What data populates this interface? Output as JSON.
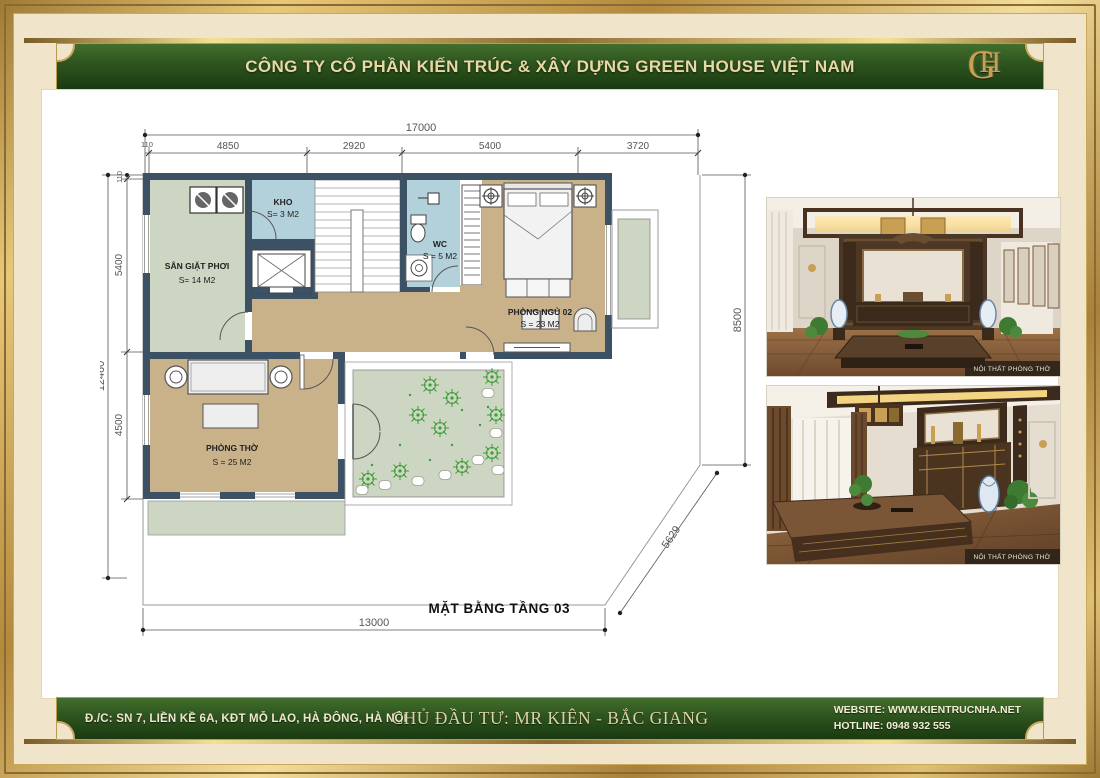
{
  "header": {
    "company": "CÔNG TY CỔ PHẦN KIẾN TRÚC & XÂY DỰNG GREEN HOUSE VIỆT NAM",
    "logo_monogram_g": "G",
    "logo_monogram_h": "H"
  },
  "plan": {
    "title": "MẶT BẰNG TẦNG 03",
    "dims": {
      "top_total": "17000",
      "top_segments": [
        "110",
        "4850",
        "2920",
        "5400",
        "3720"
      ],
      "left_total": "12460",
      "left_segments": [
        "110",
        "5400",
        "4500"
      ],
      "right_side": "8500",
      "diagonal": "5629",
      "bottom": "13000"
    },
    "rooms": {
      "laundry": {
        "name": "SÂN GIẶT PHƠI",
        "area": "S= 14 M2"
      },
      "storage": {
        "name": "KHO",
        "area": "S= 3 M2"
      },
      "wc": {
        "name": "WC",
        "area": "S = 5 M2"
      },
      "bedroom": {
        "name": "PHÒNG NGỦ 02",
        "area": "S = 23 M2"
      },
      "worship": {
        "name": "PHÒNG THỜ",
        "area": "S = 25 M2"
      }
    }
  },
  "photos": [
    {
      "caption": "NỘI THẤT PHÒNG THỜ"
    },
    {
      "caption": "NỘI THẤT PHÒNG THỜ"
    }
  ],
  "footer": {
    "address": "Đ./C: SN 7, LIỀN KỀ 6A, KĐT MỖ LAO, HÀ ĐÔNG, HÀ NỘI",
    "investor": "CHỦ ĐẦU TƯ:  MR KIÊN - BẮC GIANG",
    "website": "WEBSITE: WWW.KIENTRUCNHA.NET",
    "hotline": "HOTLINE: 0948 932 555"
  },
  "colors": {
    "frame_gold": "#c9a053",
    "banner_green": "#2f5620",
    "cream": "#f0e4cb",
    "wall": "#3d5164",
    "floor_tan": "#c9b28a",
    "room_blue": "#b3d1da",
    "sage_green": "#ccd6c3",
    "plant_green": "#3e9c33"
  }
}
